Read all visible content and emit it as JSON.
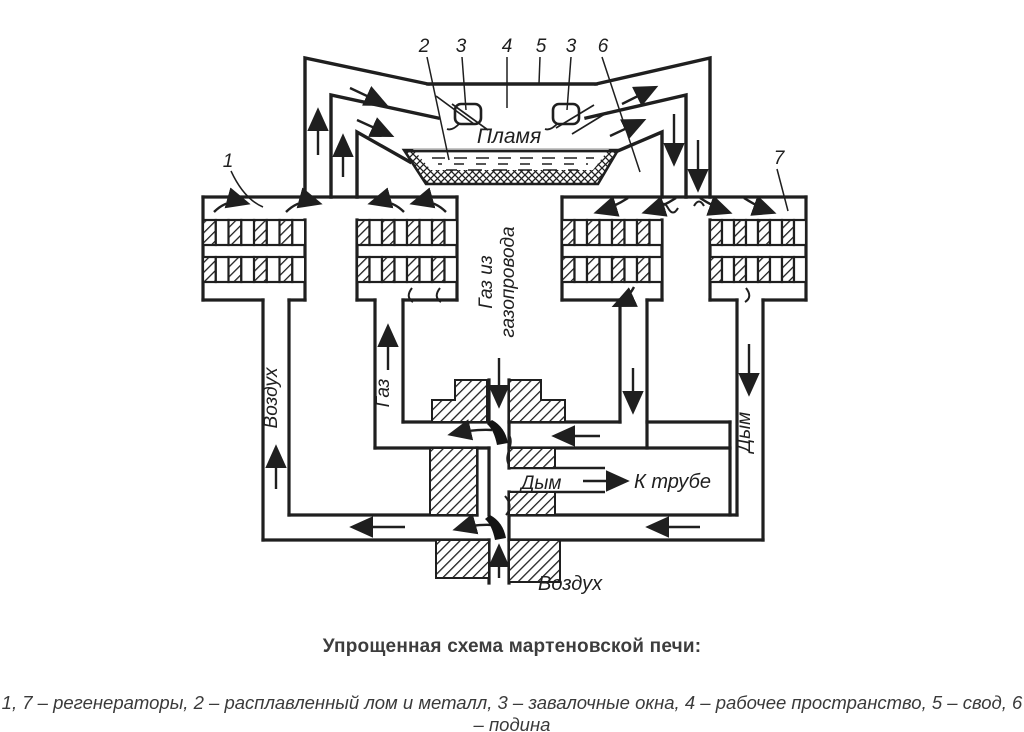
{
  "figure": {
    "caption": "Упрощенная схема мартеновской печи:",
    "legend": "1, 7 – регенераторы, 2 – расплавленный лом и металл, 3 – завалочные окна, 4 – рабочее пространство, 5 – свод, 6 – подина"
  },
  "diagram": {
    "ink_color": "#1f1f1f",
    "labels": {
      "flame": "Пламя",
      "gas_from_pipeline_line1": "Газ из",
      "gas_from_pipeline_line2": "газопровода",
      "gas_left": "Газ",
      "air_left": "Воздух",
      "smoke_right": "Дым",
      "smoke_center": "Дым",
      "to_chimney": "К трубе",
      "air_bottom": "Воздух"
    },
    "callouts": {
      "c1": "1",
      "c2": "2",
      "c3a": "3",
      "c4": "4",
      "c5": "5",
      "c3b": "3",
      "c6": "6",
      "c7": "7"
    }
  }
}
